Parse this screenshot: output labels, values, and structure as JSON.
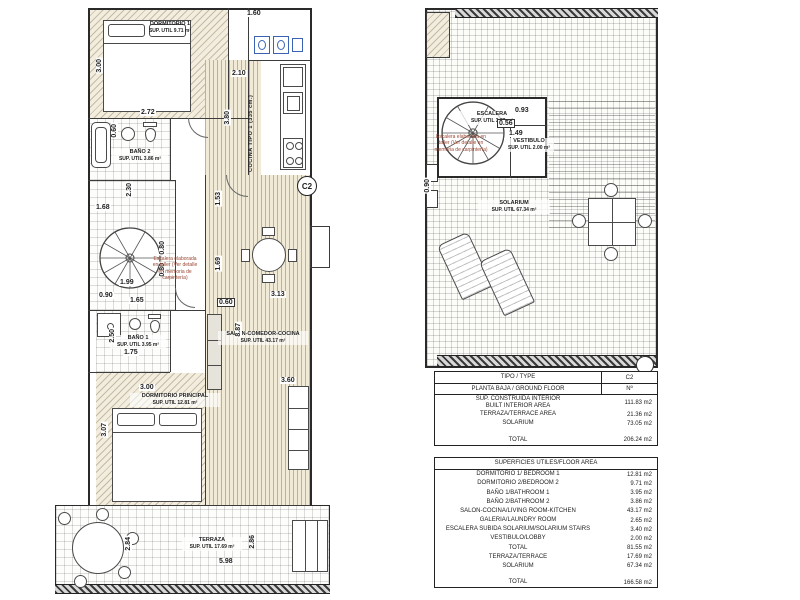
{
  "plans": {
    "left": {
      "type_badge": "C2",
      "kitchen_label": "COCINA TIPO 1 (335 cm.)",
      "note": "Escalera elaborada en taller (Ver detalle en memoria de carpintería)",
      "rooms": {
        "dormitorio1": {
          "name": "DORMITORIO 1",
          "area": "SUP. UTIL 9.71 m²"
        },
        "bano2": {
          "name": "BAÑO 2",
          "area": "SUP. UTIL 3.86 m²"
        },
        "bano1": {
          "name": "BAÑO 1",
          "area": "SUP. UTIL 3.95 m²"
        },
        "salon": {
          "name": "SALÓN-COMEDOR-COCINA",
          "area": "SUP. UTIL 43.17 m²"
        },
        "dormitorio_principal": {
          "name": "DORMITORIO PRINCIPAL",
          "area": "SUP. UTIL 12.81 m²"
        },
        "terraza": {
          "name": "TERRAZA",
          "area": "SUP. UTIL 17.69 m²"
        }
      },
      "dims": [
        "1.60",
        "2.10",
        "3.80",
        "3.00",
        "2.72",
        "0.60",
        "2.30",
        "1.68",
        "1.53",
        "1.69",
        "0.80",
        "0.80",
        "1.99",
        "0.90",
        "1.65",
        "2.50",
        "1.75",
        "3.00",
        "3.07",
        "3.13",
        "0.60",
        "8.87",
        "3.60",
        "2.84",
        "5.98",
        "2.86"
      ]
    },
    "right": {
      "note": "Escalera elaborada en taller (Ver detalle en memoria de carpintería)",
      "rooms": {
        "escalera": {
          "name": "ESCALERA",
          "area": "SUP. UTIL 3.39 m²"
        },
        "vestibulo": {
          "name": "VESTIBULO",
          "area": "SUP. UTIL 2.00 m²"
        },
        "solarium": {
          "name": "SOLARIUM",
          "area": "SUP. UTIL 67.34 m²"
        }
      },
      "dims": [
        "0.93",
        "0.56",
        "1.49",
        "0.90"
      ]
    }
  },
  "tables": {
    "summary": {
      "header_left": "TIPO / TYPE",
      "header_right": "C2",
      "subheader_left": "PLANTA BAJA / GROUND FLOOR",
      "subheader_right": "Nº",
      "rows": [
        {
          "label": "SUP. CONSTRUIDA INTERIOR\nBUILT INTERIOR AREA",
          "value": "111.83 m2"
        },
        {
          "label": "TERRAZA/TERRACE AREA",
          "value": "21.36 m2"
        },
        {
          "label": "SOLARIUM",
          "value": "73.05 m2"
        }
      ],
      "total_label": "TOTAL",
      "total_value": "206.24 m2"
    },
    "floor_area": {
      "header": "SUPERFICIES UTILES/FLOOR AREA",
      "rows": [
        {
          "label": "DORMITORIO 1/ BEDROOM 1",
          "value": "12.81 m2"
        },
        {
          "label": "DORMITORIO 2/BEDROOM 2",
          "value": "9.71 m2"
        },
        {
          "label": "BAÑO 1/BATHROOM 1",
          "value": "3.95 m2"
        },
        {
          "label": "BAÑO 2/BATHROOM 2",
          "value": "3.86 m2"
        },
        {
          "label": "SALON-COCINA/LIVING ROOM-KITCHEN",
          "value": "43.17 m2"
        },
        {
          "label": "GALERIA/LAUNDRY ROOM",
          "value": "2.65 m2"
        },
        {
          "label": "ESCALERA SUBIDA SOLARIUM/SOLARIUM STAIRS",
          "value": "3.40 m2"
        },
        {
          "label": "VESTIBULO/LOBBY",
          "value": "2.00 m2"
        },
        {
          "label": "TOTAL",
          "value": "81.55 m2"
        },
        {
          "label": "TERRAZA/TERRACE",
          "value": "17.69 m2"
        },
        {
          "label": "SOLARIUM",
          "value": "67.34 m2"
        }
      ],
      "total_label": "TOTAL",
      "total_value": "166.58 m2"
    }
  }
}
